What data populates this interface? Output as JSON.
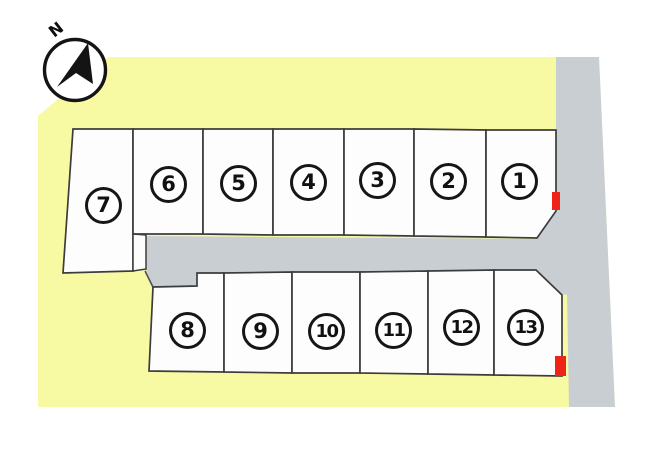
{
  "compass": {
    "label": "N"
  },
  "lots": [
    {
      "number": "1"
    },
    {
      "number": "2"
    },
    {
      "number": "3"
    },
    {
      "number": "4"
    },
    {
      "number": "5"
    },
    {
      "number": "6"
    },
    {
      "number": "7"
    },
    {
      "number": "8"
    },
    {
      "number": "9"
    },
    {
      "number": "10"
    },
    {
      "number": "11"
    },
    {
      "number": "12"
    },
    {
      "number": "13"
    }
  ],
  "markers": [
    {
      "attached_to_lot": "1"
    },
    {
      "attached_to_lot": "13"
    }
  ],
  "colors": {
    "land_yellow": "#f8f9a3",
    "road_gray": "#c9ced3",
    "lot_fill": "#fdfdfe",
    "outline": "#3c3c3c",
    "marker_red": "#ee2418",
    "compass_black": "#141414"
  }
}
